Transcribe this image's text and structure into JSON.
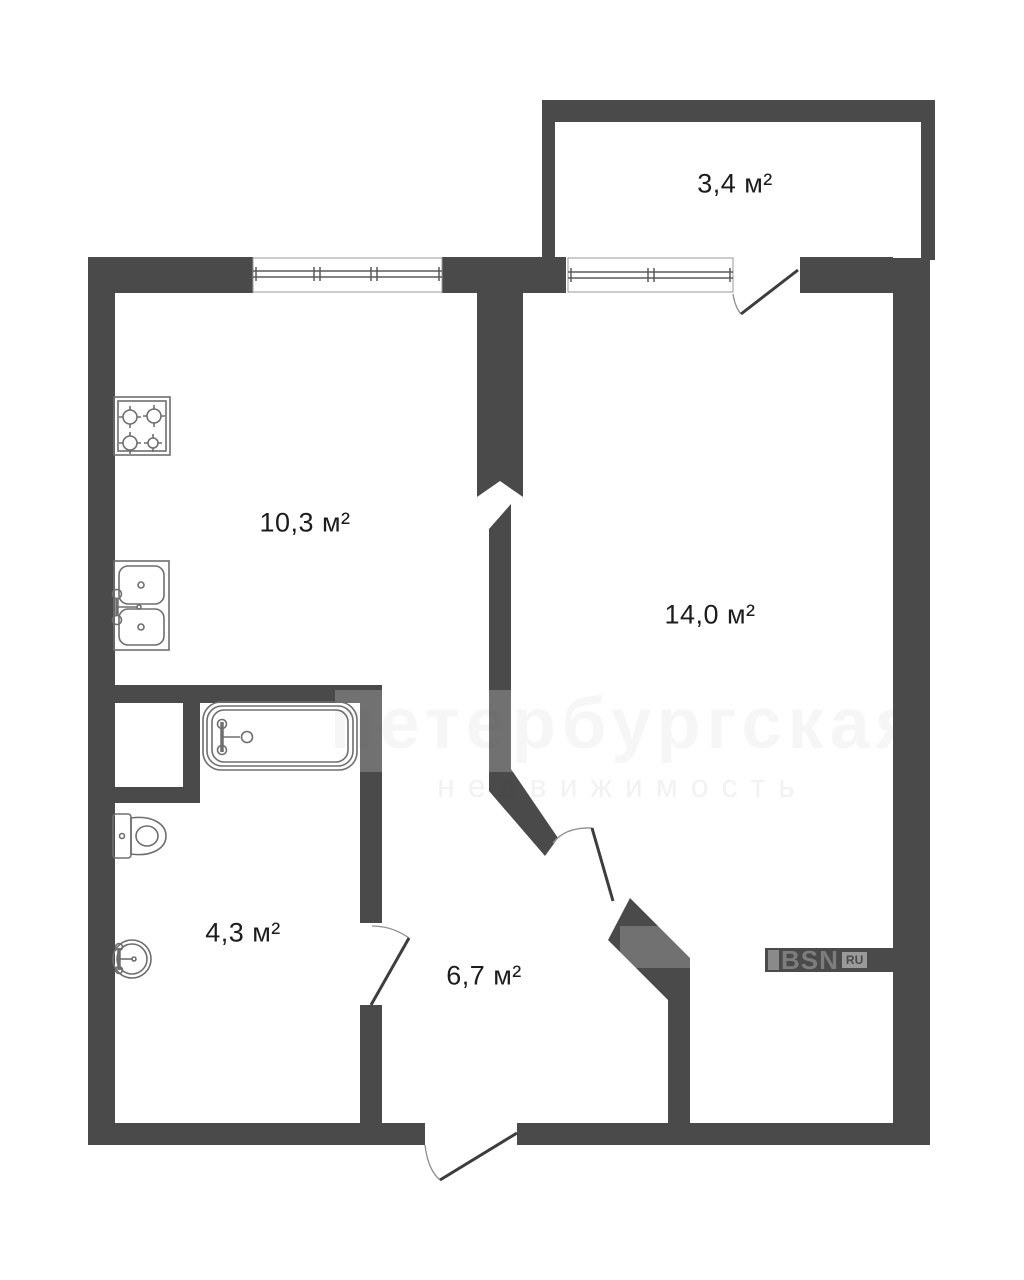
{
  "plan": {
    "rooms": [
      {
        "id": "balcony",
        "area_label": "3,4 м²"
      },
      {
        "id": "kitchen",
        "area_label": "10,3 м²"
      },
      {
        "id": "living",
        "area_label": "14,0 м²"
      },
      {
        "id": "bathroom",
        "area_label": "4,3 м²"
      },
      {
        "id": "hallway",
        "area_label": "6,7 м²"
      }
    ],
    "logo": {
      "brand": "BSN",
      "suffix": "RU"
    },
    "watermark": {
      "line1": "петербургская",
      "line2": "недвижимость"
    },
    "colors": {
      "wall": "#4a4a4a",
      "fixture": "#6e6e6e",
      "leaf": "#3d3d3d",
      "arc": "#8f8f8f",
      "label": "#1c1c1c"
    }
  }
}
